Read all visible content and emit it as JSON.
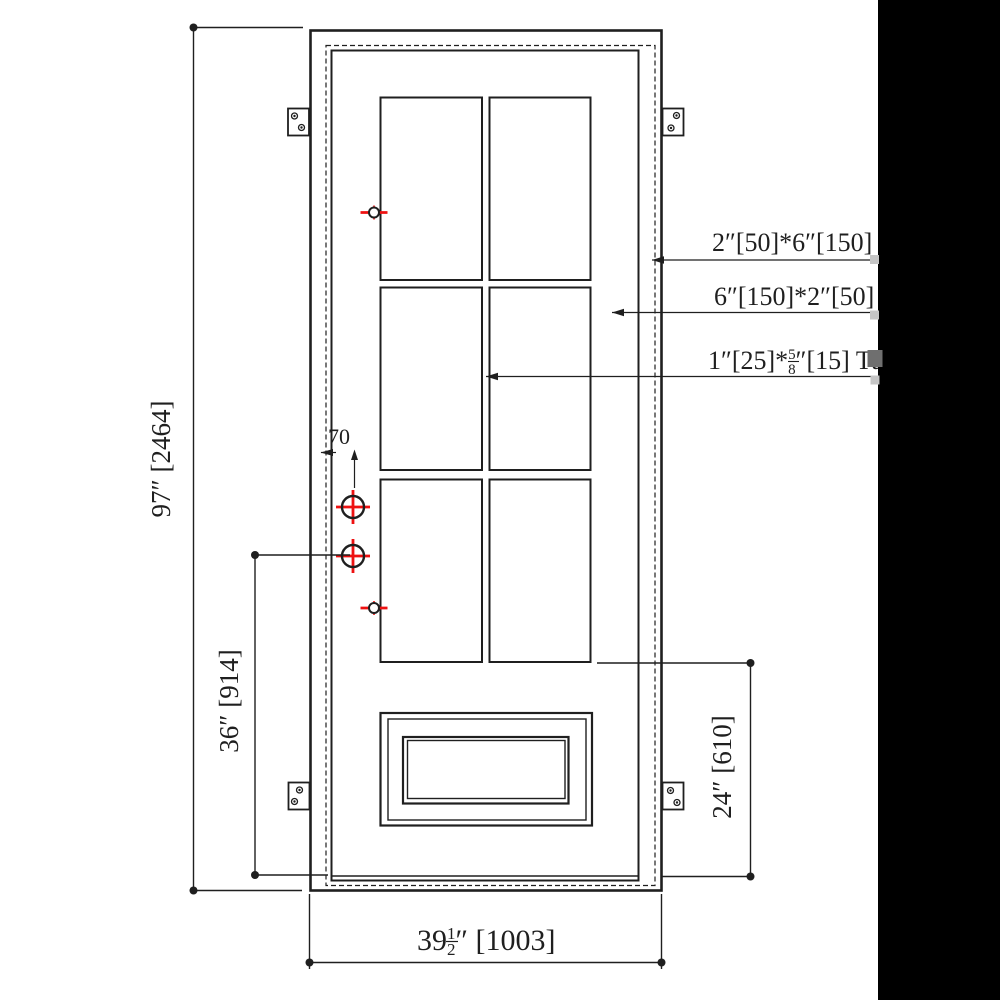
{
  "colors": {
    "line": "#1f1f1f",
    "red": "#ee1111",
    "strip": "#000000",
    "grip": "#c5c5c5",
    "grip_dark": "#6f6f6f",
    "paper": "#ffffff"
  },
  "dimensions": {
    "door_height": "97″ [2464]",
    "lock_height": "36″ [914]",
    "bottom_rail": "24″ [610]",
    "lock_backset": "70",
    "door_width_whole": "39",
    "door_width_frac_num": "1",
    "door_width_frac_den": "2",
    "door_width_rest": "″ [1003]"
  },
  "callouts": {
    "jamb_profile": "2″[50]*6″[150]",
    "stile_profile": "6″[150]*2″[50]",
    "muntin_profile_pre": "1″[25]*",
    "muntin_frac_num": "5",
    "muntin_frac_den": "8",
    "muntin_profile_post": "″[15] Tu"
  }
}
